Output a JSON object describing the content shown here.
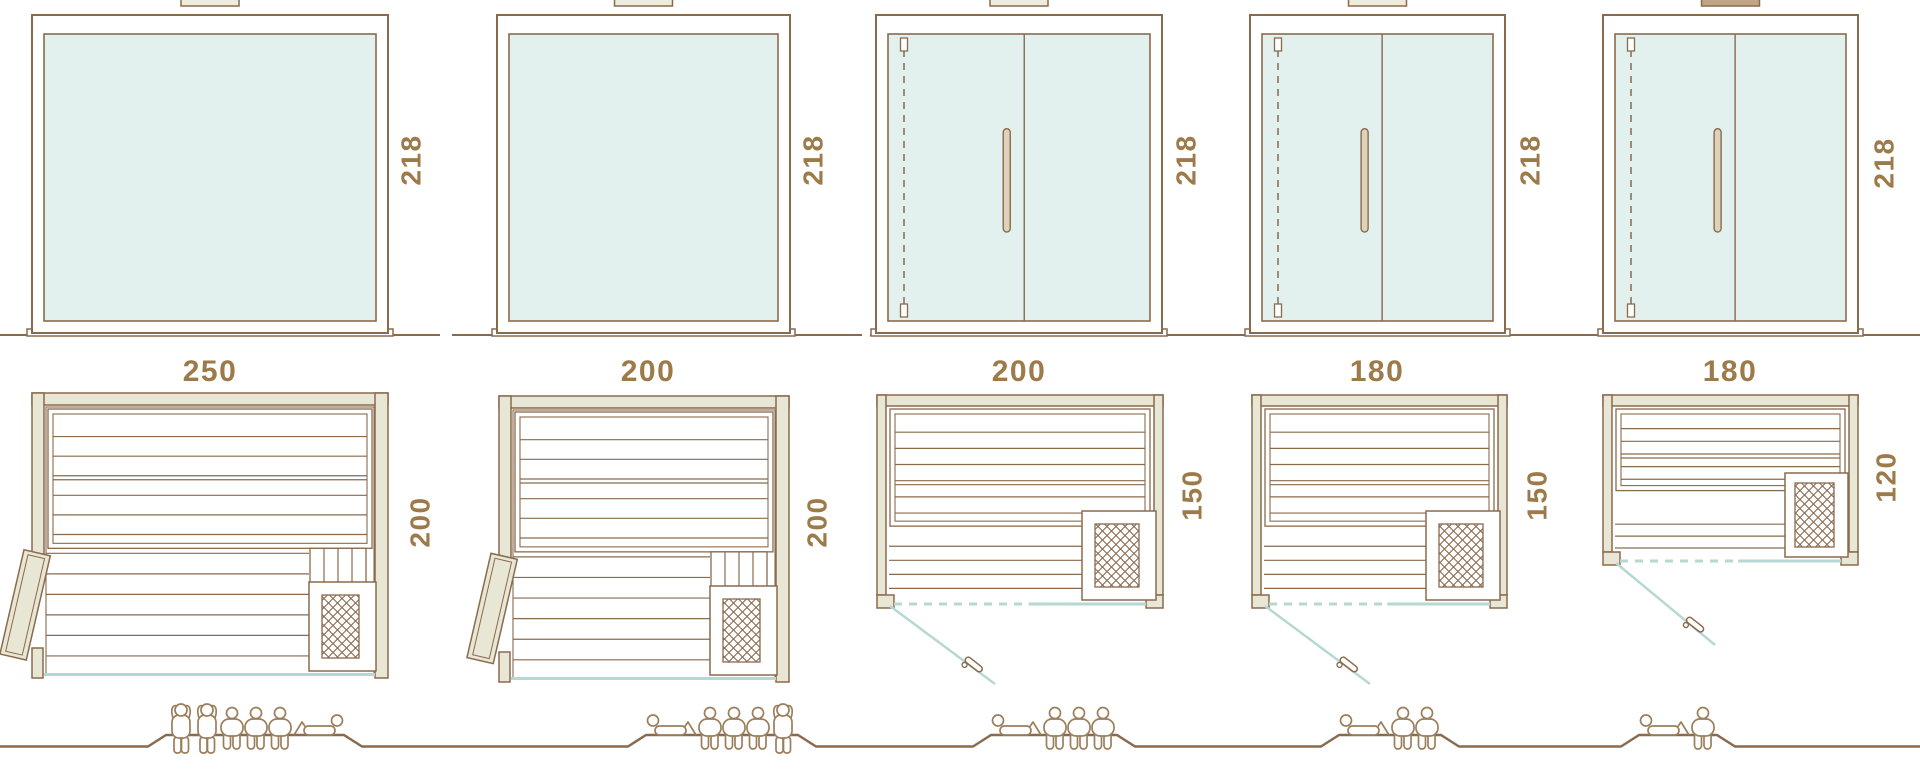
{
  "palette": {
    "line": "#8a6a4d",
    "figure": "#9b7f5c",
    "dim_text": "#9d7a49",
    "glass": "#e3f1ee",
    "wall": "#e8e6d4",
    "wall_light": "#efebdd",
    "tab_dark": "#bfa585",
    "handle_fill": "#ded2ba",
    "teal": "#b7d8d2",
    "white": "#ffffff"
  },
  "icons": {
    "heater_icon": "diamond-lattice-square",
    "door_leaf_icon": "open-hinged-door-leaf",
    "glass_door_icon": "teal-swing-door-line",
    "person_icons": [
      "person-standing",
      "person-seated",
      "person-lying"
    ]
  },
  "units": [
    {
      "id": "sauna-1",
      "elevation": {
        "type": "fixed-glass-front",
        "height_label": "218"
      },
      "width_label": "250",
      "plan": {
        "depth_label": "200",
        "door": "hinged-door-open-left",
        "heater": "heater-lattice-icon",
        "benches": "two-tier"
      },
      "capacity": {
        "standing": 2,
        "seated": 3,
        "lying": 1
      }
    },
    {
      "id": "sauna-2",
      "elevation": {
        "type": "fixed-glass-front",
        "height_label": "218"
      },
      "width_label": "200",
      "plan": {
        "depth_label": "200",
        "door": "hinged-door-open-left",
        "heater": "heater-lattice-icon",
        "benches": "two-tier"
      },
      "capacity": {
        "standing": 1,
        "seated": 3,
        "lying": 1
      }
    },
    {
      "id": "sauna-3",
      "elevation": {
        "type": "glass-double-door",
        "height_label": "218"
      },
      "width_label": "200",
      "plan": {
        "depth_label": "150",
        "door": "glass-door-swing-open",
        "heater": "heater-lattice-icon",
        "benches": "two-tier"
      },
      "capacity": {
        "standing": 0,
        "seated": 3,
        "lying": 1
      }
    },
    {
      "id": "sauna-4",
      "elevation": {
        "type": "glass-double-door",
        "height_label": "218"
      },
      "width_label": "180",
      "plan": {
        "depth_label": "150",
        "door": "glass-door-swing-open",
        "heater": "heater-lattice-icon",
        "benches": "two-tier"
      },
      "capacity": {
        "standing": 0,
        "seated": 2,
        "lying": 1
      }
    },
    {
      "id": "sauna-5",
      "elevation": {
        "type": "glass-double-door",
        "height_label": "218"
      },
      "width_label": "180",
      "plan": {
        "depth_label": "120",
        "door": "glass-door-swing-open",
        "heater": "heater-lattice-icon",
        "benches": "two-tier"
      },
      "capacity": {
        "standing": 0,
        "seated": 1,
        "lying": 1
      }
    }
  ]
}
